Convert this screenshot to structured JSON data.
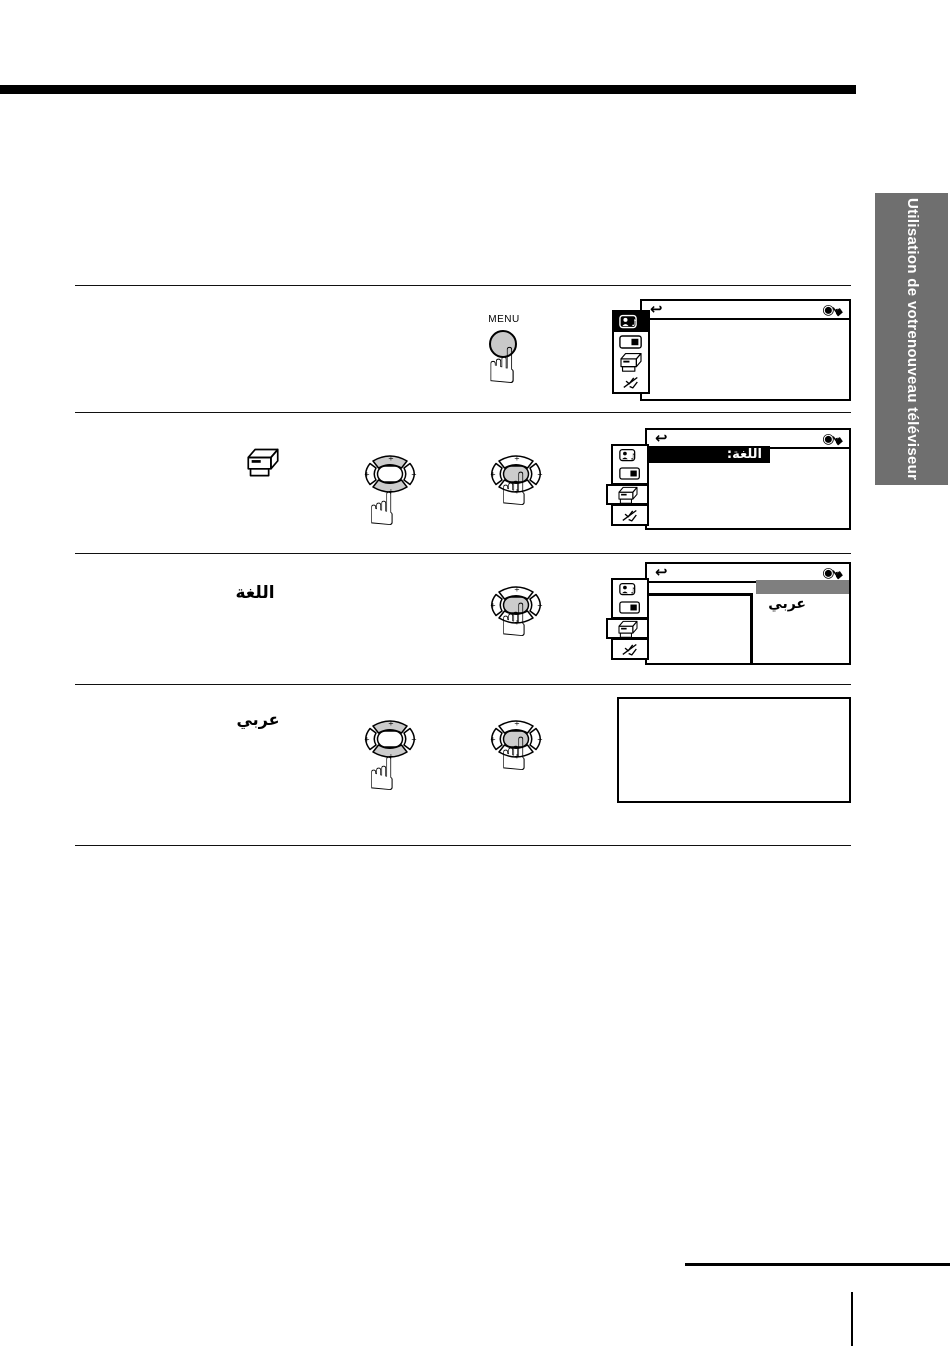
{
  "sidebar_tab": {
    "line1": "Utilisation de votre",
    "line2": "nouveau téléviseur"
  },
  "remote": {
    "menu_button_label": "MENU",
    "plus_mark": "+"
  },
  "icons": {
    "return_arrow": "↩",
    "fisheye": "◉",
    "hand_pointer_black": "☛",
    "hand_pointing": "☝",
    "music_note": "♪"
  },
  "tv_menu": {
    "language_row_label": "اللغة:",
    "language_option_selected": "عربي",
    "sidebar_icons": [
      "user-sound-icon",
      "display-icon",
      "setup-box-icon",
      "antenna-icon"
    ]
  },
  "step_labels": {
    "language_menu": "اللغة",
    "arabic_option": "عربي"
  },
  "colors": {
    "tab_gray": "#6f6f6f",
    "pad_shade": "#cccccc",
    "menu_highlight": "#000000",
    "option_bar_gray": "#7f7f7f"
  }
}
